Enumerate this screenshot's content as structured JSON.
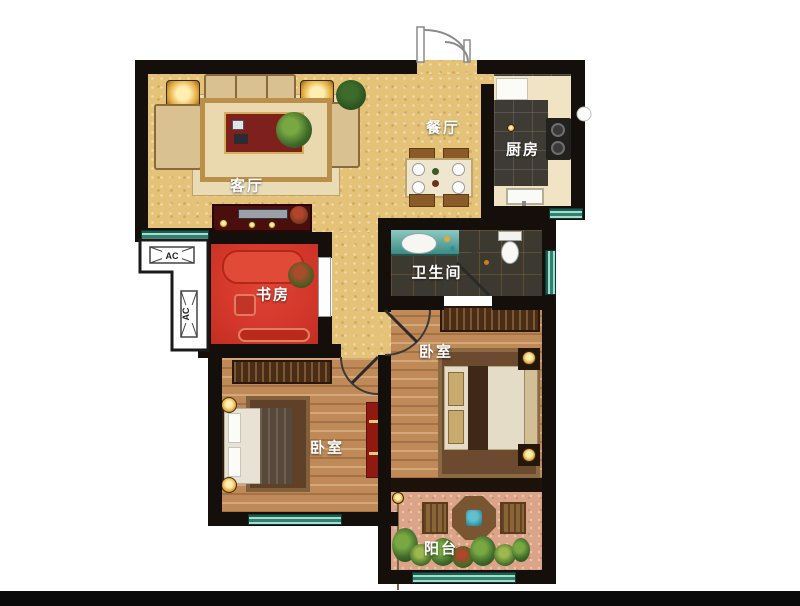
{
  "rooms": {
    "living": {
      "label": "客厅"
    },
    "dining": {
      "label": "餐厅"
    },
    "kitchen": {
      "label": "厨房"
    },
    "bathroom": {
      "label": "卫生间"
    },
    "study": {
      "label": "书房"
    },
    "bedroom_left": {
      "label": "卧室"
    },
    "bedroom_right": {
      "label": "卧室"
    },
    "balcony": {
      "label": "阳台"
    }
  },
  "annotations": {
    "ac_platform_top": "AC",
    "ac_platform_side": "AC"
  },
  "colors": {
    "wall": "#140f0a",
    "living_floor": "#e4c379",
    "kitchen_tile": "#3e3b34",
    "bathroom_tile": "#3c3931",
    "study_floor": "#d5382b",
    "wood_floor": "#c08a58",
    "balcony_floor": "#dba488",
    "window_teal": "#2e8273",
    "label_text": "#ffffff",
    "footer_band": "#0a0a0a"
  }
}
